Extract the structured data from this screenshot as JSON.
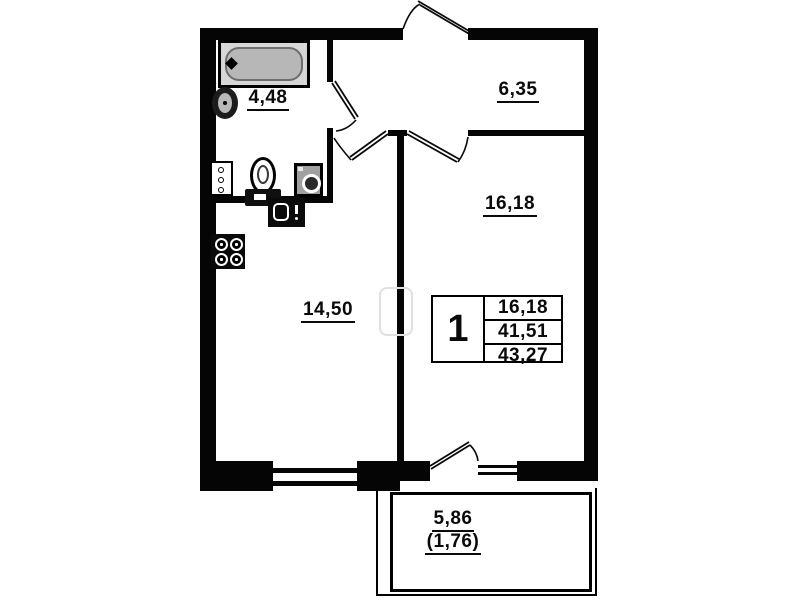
{
  "title": "apartment-floor-plan",
  "rooms": {
    "bathroom": {
      "area": "4,48"
    },
    "hallway": {
      "area": "6,35"
    },
    "living_room": {
      "area": "16,18"
    },
    "kitchen_living": {
      "area": "14,50"
    },
    "balcony": {
      "area": "5,86",
      "area_reduced": "(1,76)"
    }
  },
  "info_table": {
    "rooms_count": "1",
    "living_area": "16,18",
    "apartment_area": "41,51",
    "total_area": "43,27"
  },
  "fixtures": {
    "bathtub": "bathtub-icon",
    "washbasin": "washbasin-icon",
    "toilet": "toilet-icon",
    "washing_machine": "washing-machine-icon",
    "kitchen_sink": "kitchen-sink-icon",
    "stove": "stove-icon"
  },
  "colors": {
    "wall": "#050505",
    "tub_fill": "#b7b7b7",
    "paper": "#ffffff"
  }
}
